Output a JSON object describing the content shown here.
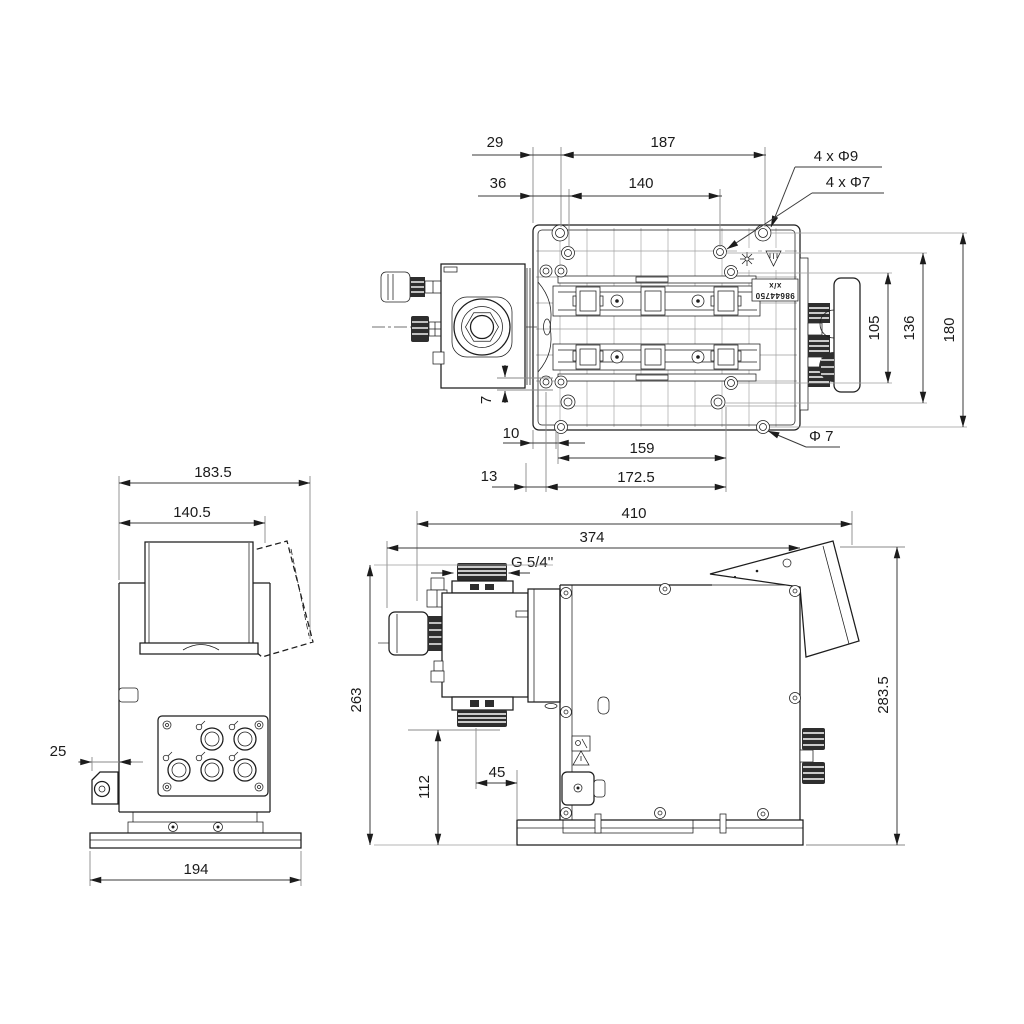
{
  "top_view": {
    "d29": "29",
    "d187": "187",
    "d36": "36",
    "d140": "140",
    "holes_label_1": "4 x Φ9",
    "holes_label_2": "4 x Φ7",
    "d105": "105",
    "d136": "136",
    "d180": "180",
    "d7": "7",
    "d10": "10",
    "d159": "159",
    "hole_dia_label": "Φ 7",
    "d13": "13",
    "d172_5": "172.5",
    "marking_line1": "x/x",
    "marking_line2": "98644750"
  },
  "side_view": {
    "d183_5": "183.5",
    "d140_5": "140.5",
    "d25": "25",
    "d194": "194"
  },
  "front_view": {
    "d410": "410",
    "d374": "374",
    "thread_label": "G 5/4''",
    "d263": "263",
    "d283_5": "283.5",
    "d112": "112",
    "d45": "45"
  }
}
